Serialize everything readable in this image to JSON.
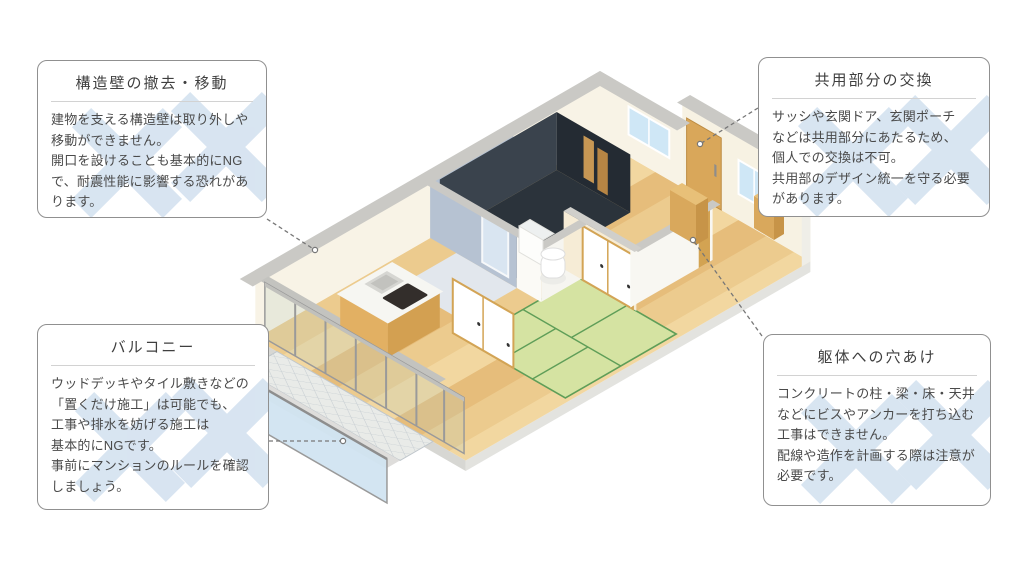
{
  "figure": {
    "kind": "isometric apartment floor plan with renovation NG annotations"
  },
  "callouts": [
    {
      "id": "structural-wall",
      "title": "構造壁の撤去・移動",
      "body": "建物を支える構造壁は取り外しや\n移動ができません。\n開口を設けることも基本的にNG\nで、耐震性能に影響する恐れがあ\nります。"
    },
    {
      "id": "common-area",
      "title": "共用部分の交換",
      "body": "サッシや玄関ドア、玄関ポーチ\nなどは共用部分にあたるため、\n個人での交換は不可。\n共用部のデザイン統一を守る必要\nがあります。"
    },
    {
      "id": "balcony",
      "title": "バルコニー",
      "body": "ウッドデッキやタイル敷きなどの\n「置くだけ施工」は可能でも、\n工事や排水を妨げる施工は\n基本的にNGです。\n事前にマンションのルールを確認\nしましょう。"
    },
    {
      "id": "structure-drilling",
      "title": "躯体への穴あけ",
      "body": "コンクリートの柱・梁・床・天井\nなどにビスやアンカーを打ち込む\n工事はできません。\n配線や造作を計画する際は注意が\n必要です。"
    }
  ],
  "colors": {
    "x_mark": "#b9cfe6",
    "wood_floor": "#eccb8e",
    "tatami": "#d5e3a2",
    "tatami_line": "#5f9e58",
    "balcony_glass": "#cfe3f1",
    "wall_cream": "#f8f3e6",
    "wall_blue_gray": "#b6c2d2",
    "bath_dark": "#2b333b",
    "door_wood": "#d9a75a",
    "window_glass": "#cfe7f6",
    "wall_cap_gray": "#cac9c5",
    "callout_border": "#909090",
    "connector": "#777777",
    "text": "#4a4a4a"
  }
}
